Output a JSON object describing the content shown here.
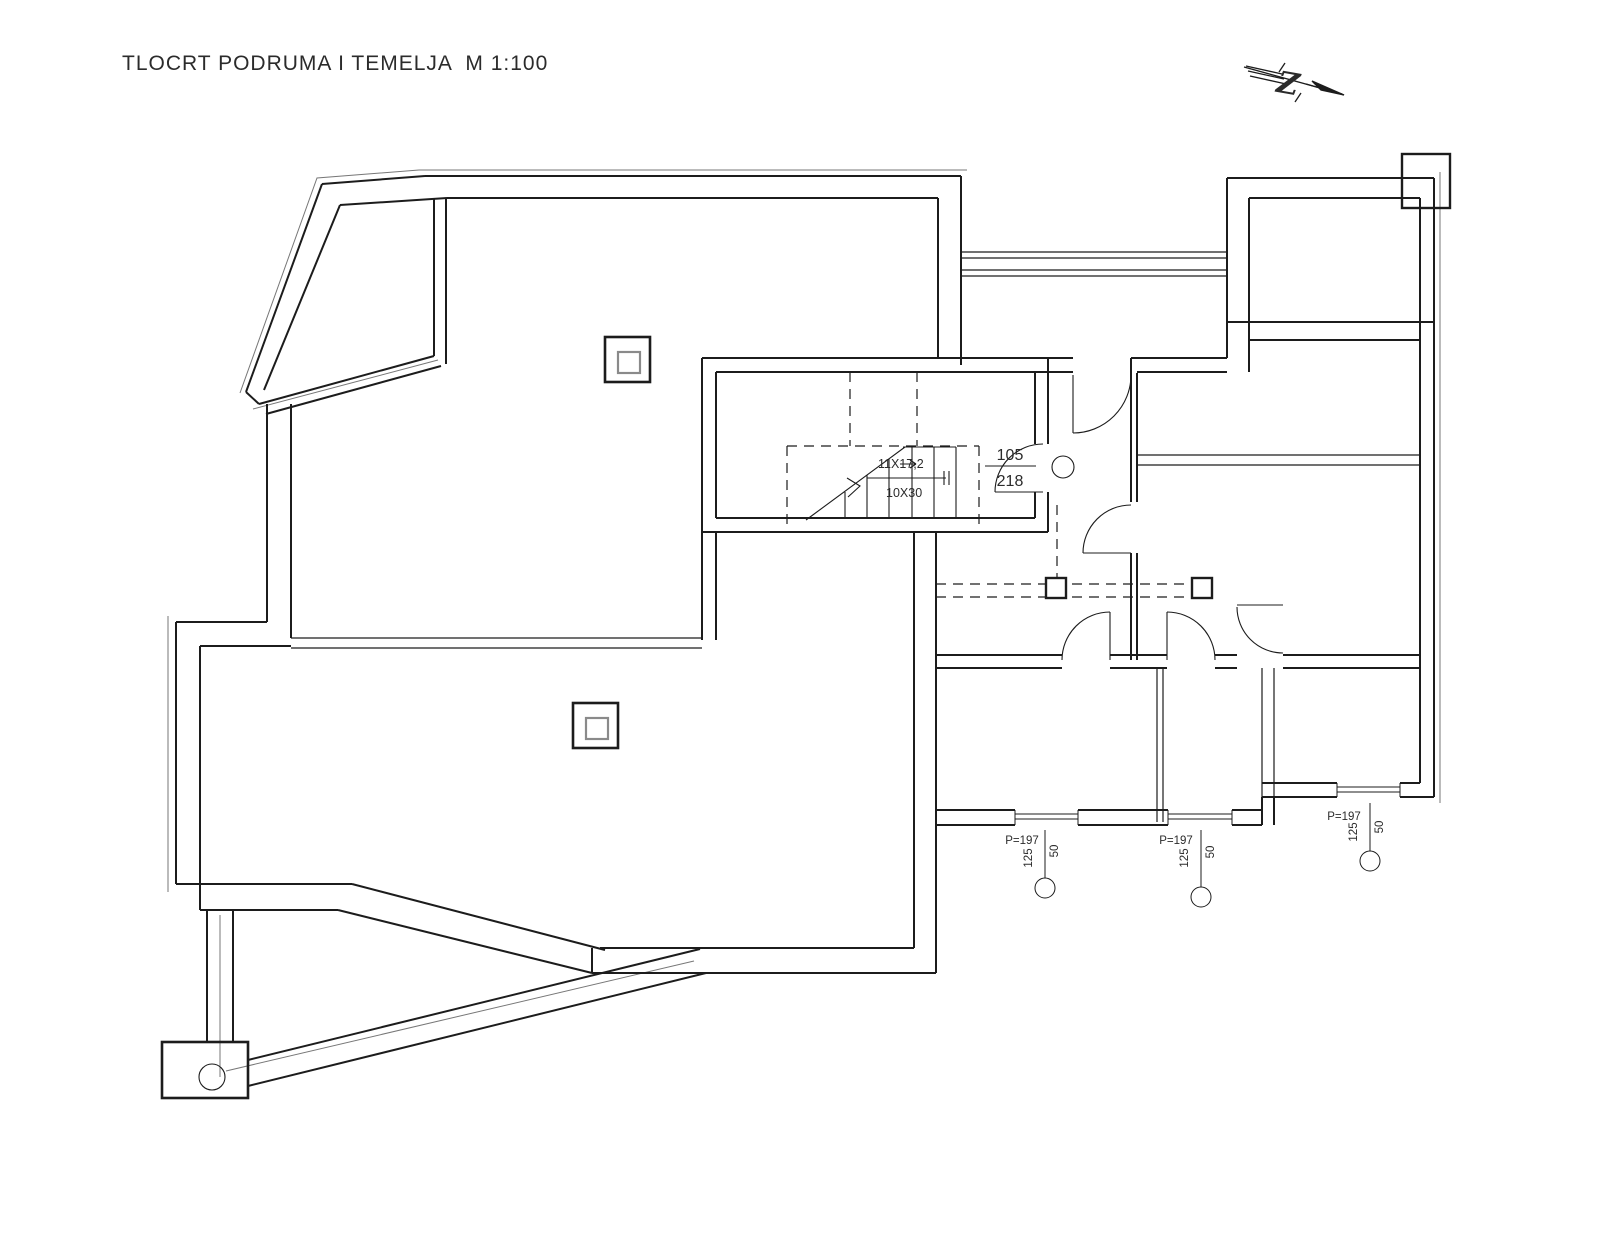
{
  "title": "TLOCRT PODRUMA I TEMELJA  M 1:100",
  "north_arrow": {
    "label": "Z"
  },
  "stairs": {
    "risers_label": "11X17,2",
    "treads_label": "10X30"
  },
  "door_tag": {
    "width": "105",
    "height": "218"
  },
  "window_tags": [
    {
      "sill": "P=197",
      "width": "125",
      "height": "50"
    },
    {
      "sill": "P=197",
      "width": "125",
      "height": "50"
    },
    {
      "sill": "P=197",
      "width": "125",
      "height": "50"
    }
  ],
  "colors": {
    "line": "#1c1c1c",
    "thin_line": "#777777",
    "background": "#ffffff"
  }
}
